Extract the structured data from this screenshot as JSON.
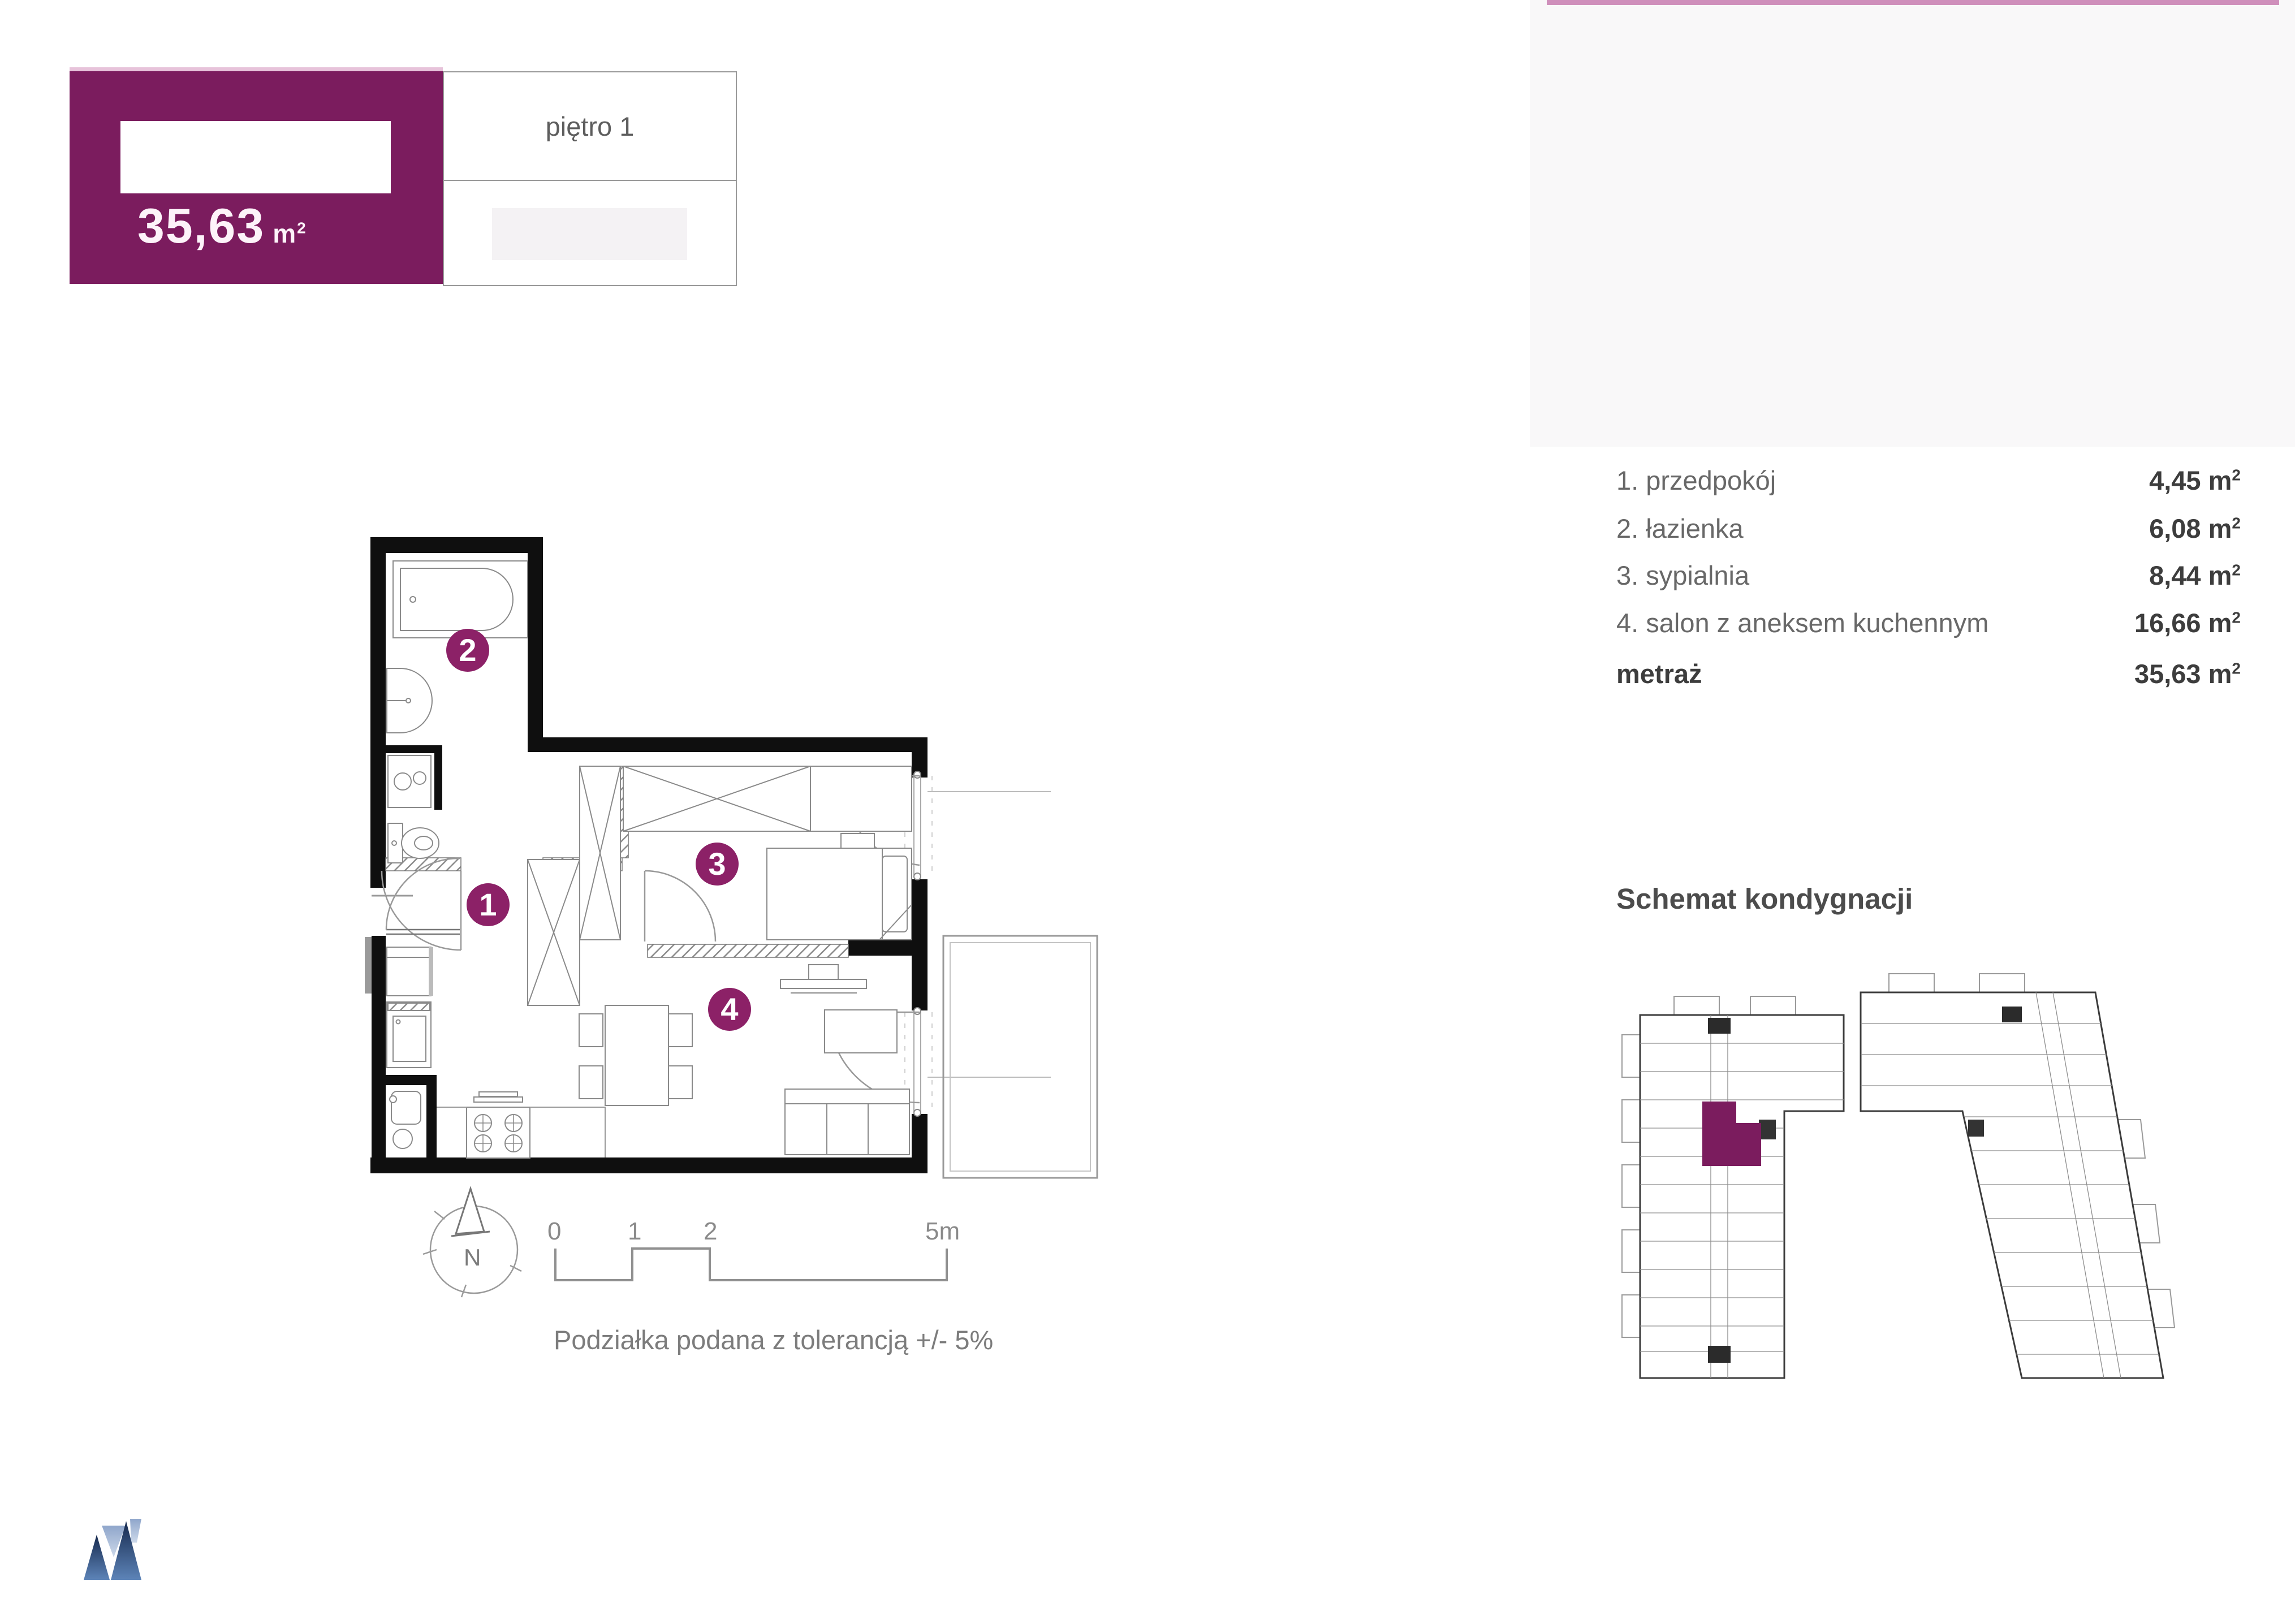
{
  "header": {
    "area": "35,63",
    "area_unit_base": "m",
    "area_unit_exp": "2",
    "floor_label": "piętro 1"
  },
  "room_list": {
    "rows": [
      {
        "label": "1. przedpokój",
        "value": "4,45"
      },
      {
        "label": "2. łazienka",
        "value": "6,08"
      },
      {
        "label": "3. sypialnia",
        "value": "8,44"
      },
      {
        "label": "4. salon z aneksem kuchennym",
        "value": "16,66"
      }
    ],
    "total_label": "metraż",
    "total_value": "35,63",
    "unit_base": "m",
    "unit_exp": "2"
  },
  "plan": {
    "circles": [
      {
        "label": "1"
      },
      {
        "label": "2"
      },
      {
        "label": "3"
      },
      {
        "label": "4"
      }
    ]
  },
  "schematic": {
    "title": "Schemat kondygnacji"
  },
  "scalebar": {
    "ticks": [
      "0",
      "1",
      "2",
      "5m"
    ],
    "note": "Podziałka podana z tolerancją +/- 5%"
  },
  "compass": {
    "label": "N"
  },
  "colors": {
    "brand_purple": "#7b1c5e",
    "circle_purple": "#8c2167",
    "accent_pink": "#cf8fbb",
    "wall_black": "#0f0f0f",
    "logo_blue_dark": "#2a4a7c",
    "logo_blue_light": "#a9bedd"
  }
}
